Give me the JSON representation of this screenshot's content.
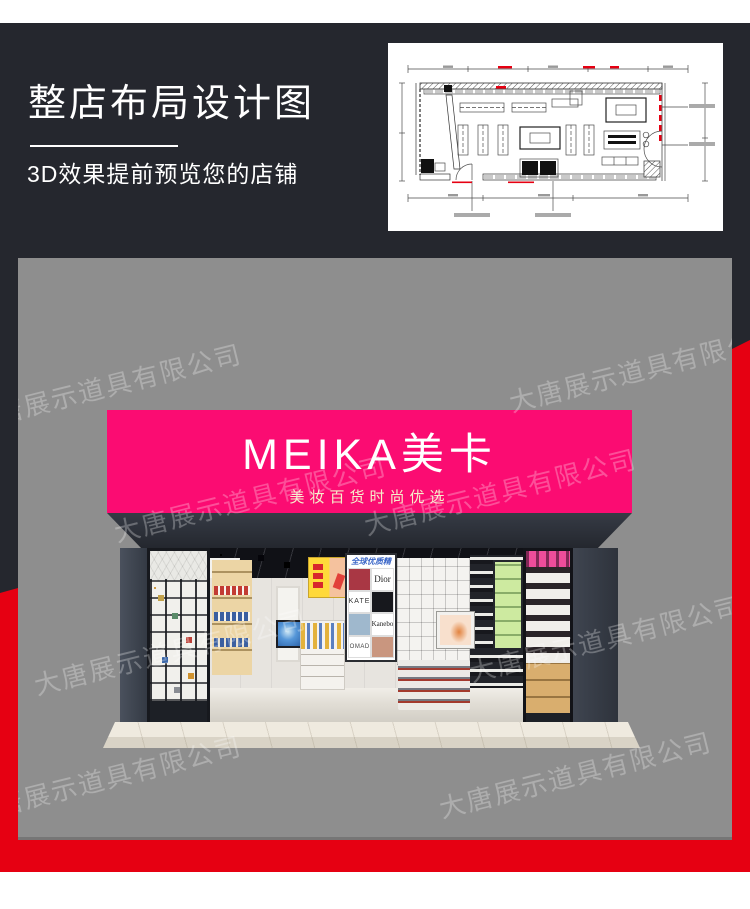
{
  "colors": {
    "page_bg": "#ffffff",
    "dark_bg": "#25272e",
    "accent_red": "#e60012",
    "panel_gray": "#8e8e8e",
    "sign_pink": "#fb0c72",
    "sign_text": "#ffffff",
    "sign_subtext": "#f6eecb"
  },
  "header": {
    "title": "整店布局设计图",
    "subtitle": "3D效果提前预览您的店铺"
  },
  "floorplan": {
    "name": "store-layout-cad-drawing"
  },
  "storefront": {
    "sign_title": "MEIKA美卡",
    "sign_subtitle": "美妆百货时尚优选",
    "poster": {
      "header": "全球优质精品",
      "brands": [
        "Dior",
        "KATE",
        "Kanebo",
        "NOMADE"
      ]
    }
  },
  "watermark": {
    "text": "大唐展示道具有限公司"
  }
}
